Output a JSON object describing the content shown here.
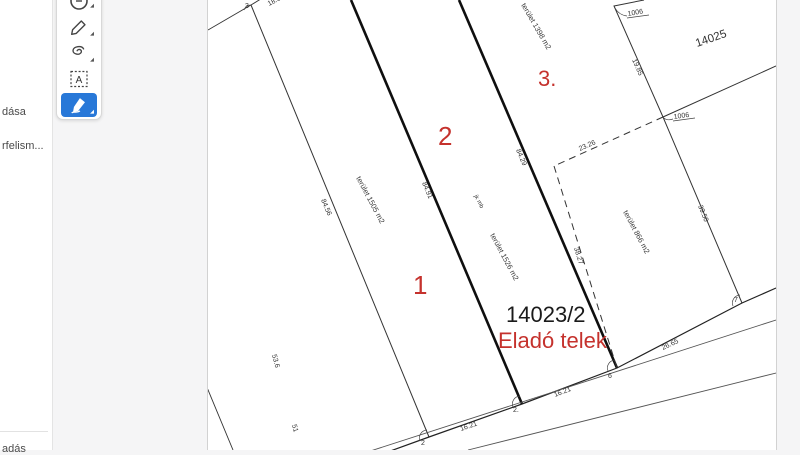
{
  "sidebar": {
    "items": [
      {
        "label": "dása"
      },
      {
        "label": "rfelism..."
      },
      {
        "label": "adás"
      }
    ]
  },
  "toolbar": {
    "active_color": "#2878d8",
    "tools": [
      {
        "name": "shape-tool"
      },
      {
        "name": "pen-tool"
      },
      {
        "name": "lasso-tool"
      },
      {
        "name": "text-box-tool",
        "glyph": "A"
      },
      {
        "name": "highlighter-tool",
        "active": true
      }
    ]
  },
  "drawing": {
    "parcel_label": "14023/2",
    "sale_label": "Eladó telek",
    "adjacent_parcel": "14025",
    "plot_numbers": {
      "one": "1",
      "two": "2",
      "three": "3."
    },
    "areas": {
      "plot1": "terület 1505 m2",
      "plot2": "terület 1526 m2",
      "plot3": "terület 1398 m2",
      "sub": "terület 866 m2",
      "note": "jk mb"
    },
    "dimensions": {
      "t1": "84.56",
      "a": "84.91",
      "b": "84.29",
      "d19": "19.85",
      "d39": "39.50",
      "d23": "23.26",
      "d38": "38.27",
      "front1": "16.21",
      "front2": "16.21",
      "front3": "26.65",
      "top": "18.01",
      "left1": "53.6",
      "left2": "51"
    },
    "points": {
      "p3": "3",
      "p2": "2",
      "p2b": "2.",
      "p6": "6",
      "p7": "7"
    },
    "nodes": {
      "a": "1006",
      "b": "1006"
    },
    "colors": {
      "red": "#c5322d",
      "ink": "#1a1a1a"
    }
  }
}
